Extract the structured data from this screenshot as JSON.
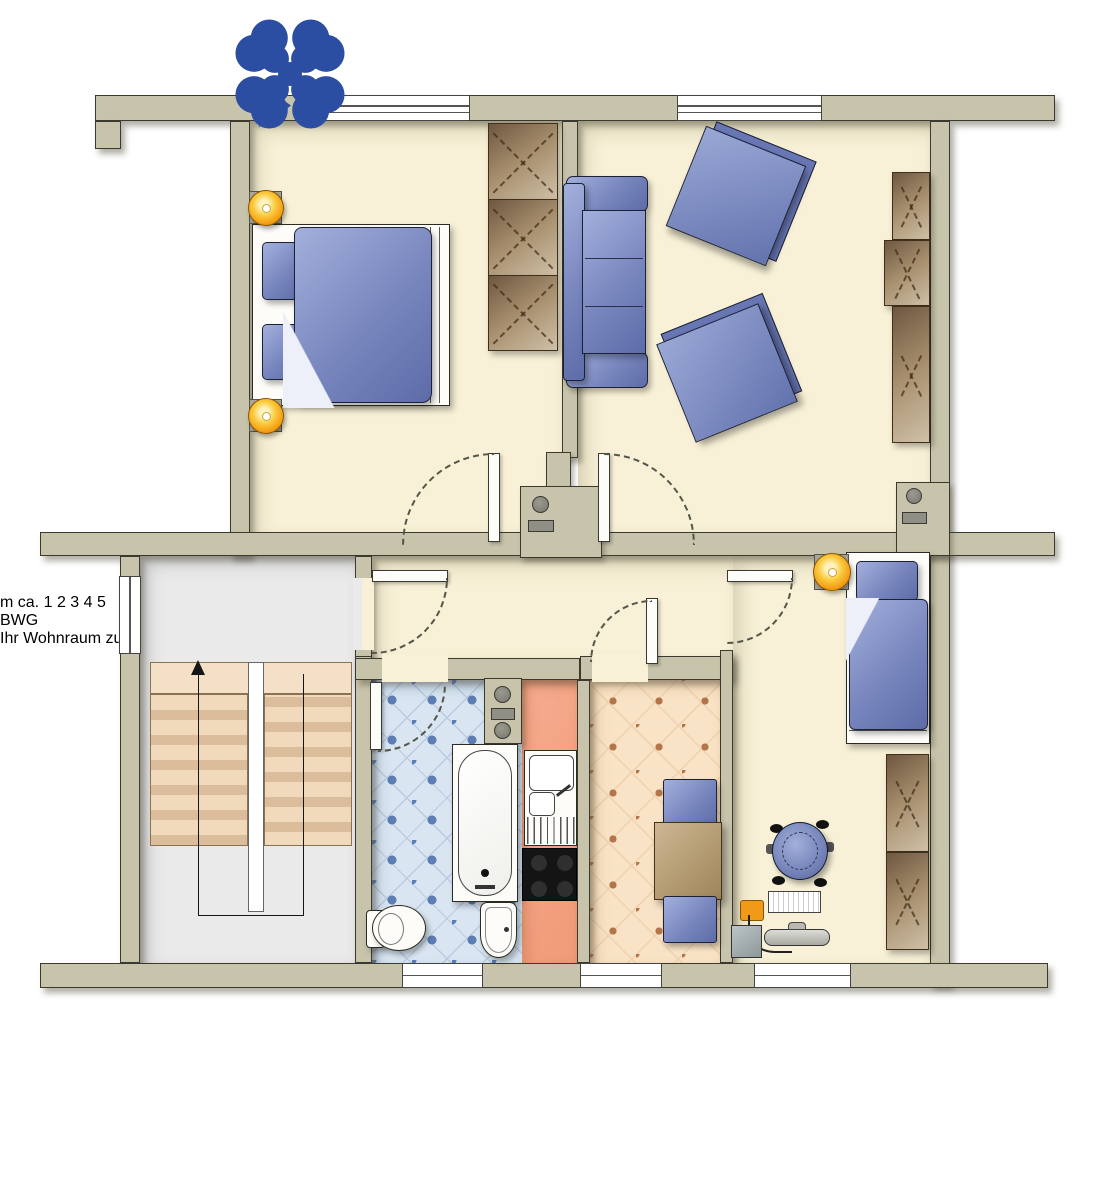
{
  "page": {
    "type": "apartment-floor-plan",
    "background": "#ffffff"
  },
  "palette": {
    "wall": "#C8C4AB",
    "wall_outline": "#3A3A2E",
    "room_floor": "#F8F1D7",
    "stairwell_floor": "#EAEAEA",
    "bathroom_tile": "#D9E6F2",
    "bathroom_dot": "#5C7EB4",
    "kitchen_floor": "#F4A284",
    "dining_floor": "#F9E3C6",
    "dining_dot": "#B5754B",
    "stair_steps": "#F1DABC",
    "furniture_blue": "#7886BE",
    "cabinet_brown": "#A8906F",
    "lamp_orange": "#F29B13",
    "entrance_arrow_orange": "#F5801E",
    "scale_bar_black": "#1A1A1A"
  },
  "rooms": [
    {
      "id": "bedroom",
      "furniture": [
        "double-bed",
        "bedside-lamp",
        "bedside-lamp",
        "wardrobe"
      ]
    },
    {
      "id": "living-room",
      "furniture": [
        "sofa",
        "armchair",
        "armchair",
        "round-coffee-table",
        "tv-sideboard",
        "service-shaft"
      ]
    },
    {
      "id": "hallway",
      "furniture": [
        "entrance-arrow"
      ]
    },
    {
      "id": "stairwell",
      "furniture": [
        "staircase",
        "up-arrow-path"
      ]
    },
    {
      "id": "bathroom",
      "furniture": [
        "bathtub",
        "toilet",
        "washbasin",
        "vent-shaft"
      ]
    },
    {
      "id": "kitchen",
      "furniture": [
        "sink-unit",
        "stove"
      ]
    },
    {
      "id": "dining-room",
      "furniture": [
        "dining-table",
        "chair",
        "chair"
      ]
    },
    {
      "id": "small-bedroom",
      "furniture": [
        "single-bed",
        "bedside-lamp",
        "wardrobe",
        "desk",
        "computer",
        "office-chair"
      ]
    },
    {
      "id": "balcony",
      "furniture": [
        "flower-plant",
        "green-plant"
      ]
    }
  ],
  "scale_bar": {
    "prefix": "m ca.",
    "ticks": [
      "1",
      "2",
      "3",
      "4",
      "5"
    ],
    "segment_colors": [
      "#ffffff",
      "#1A1A1A",
      "#ffffff",
      "#1A1A1A",
      "#ffffff"
    ]
  },
  "logo": {
    "text": "BWG",
    "tagline": "Ihr Wohnraum zum Glück.",
    "blue": "#2B4EA2",
    "yellow": "#F2AF1D"
  }
}
